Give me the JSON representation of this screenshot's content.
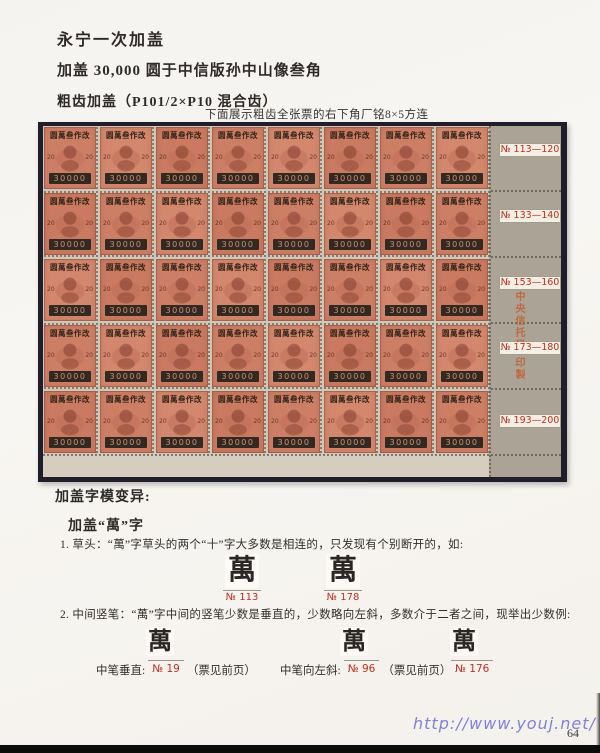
{
  "page": {
    "title": "永宁一次加盖",
    "subtitle": "加盖 30,000 圆于中信版孙中山像叁角",
    "perforation_line": "粗齿加盖（P101/2×P10 混合齿）",
    "sheet_caption": "下面展示粗齿全张票的右下角厂铭8×5方连",
    "page_number": "64",
    "watermark": "http://www.youj.net/"
  },
  "sheet": {
    "columns": 8,
    "rows": 5,
    "stamp": {
      "overprint": "圆萬叁作改",
      "denomination": "20",
      "value": "30000"
    },
    "row_labels": [
      "№ 113—120",
      "№ 133—140",
      "№ 153—160",
      "№ 173—180",
      "№ 193—200"
    ],
    "imprint_top": "中央信托局",
    "imprint_bottom": "印製"
  },
  "variants": {
    "heading": "加盖字模变异:",
    "subheading": "加盖“萬”字",
    "item1": "1.  草头：“萬”字草头的两个“十”字大多数是相连的，只发现有个别断开的，如:",
    "item2": "2.  中间竖笔：“萬”字中间的竖笔少数是垂直的，少数略向左斜，多数介于二者之间，现举出少数例:",
    "glyph": "萬",
    "examples1": [
      {
        "label": "№ 113"
      },
      {
        "label": "№ 178"
      }
    ],
    "examples2": [
      {
        "prefix": "中笔垂直:",
        "num": "№ 19",
        "suffix": "（票见前页）"
      },
      {
        "prefix": "中笔向左斜:",
        "num": "№ 96",
        "suffix": "（票见前页）"
      },
      {
        "prefix": "",
        "num": "№ 176",
        "suffix": ""
      }
    ]
  }
}
